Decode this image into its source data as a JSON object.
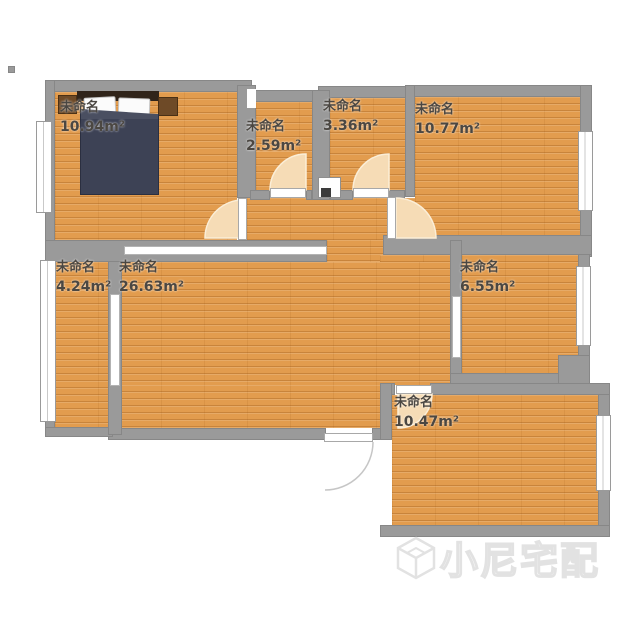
{
  "floorplan": {
    "rooms": [
      {
        "name": "未命名",
        "area": "10.94m²"
      },
      {
        "name": "未命名",
        "area": "2.59m²"
      },
      {
        "name": "未命名",
        "area": "3.36m²"
      },
      {
        "name": "未命名",
        "area": "10.77m²"
      },
      {
        "name": "未命名",
        "area": "4.24m²"
      },
      {
        "name": "未命名",
        "area": "26.63m²"
      },
      {
        "name": "未命名",
        "area": "6.55m²"
      },
      {
        "name": "未命名",
        "area": "10.47m²"
      }
    ]
  },
  "watermark": {
    "brand": "小尼宅配",
    "logo_icon": "cube-logo"
  },
  "colors": {
    "floor": "#e29c4e",
    "wall": "#9a9a9a",
    "door_arc": "#f6dcb6",
    "bed_duvet": "#3d4255",
    "label_text": "#4b4742",
    "watermark": "#e2e2e2"
  }
}
